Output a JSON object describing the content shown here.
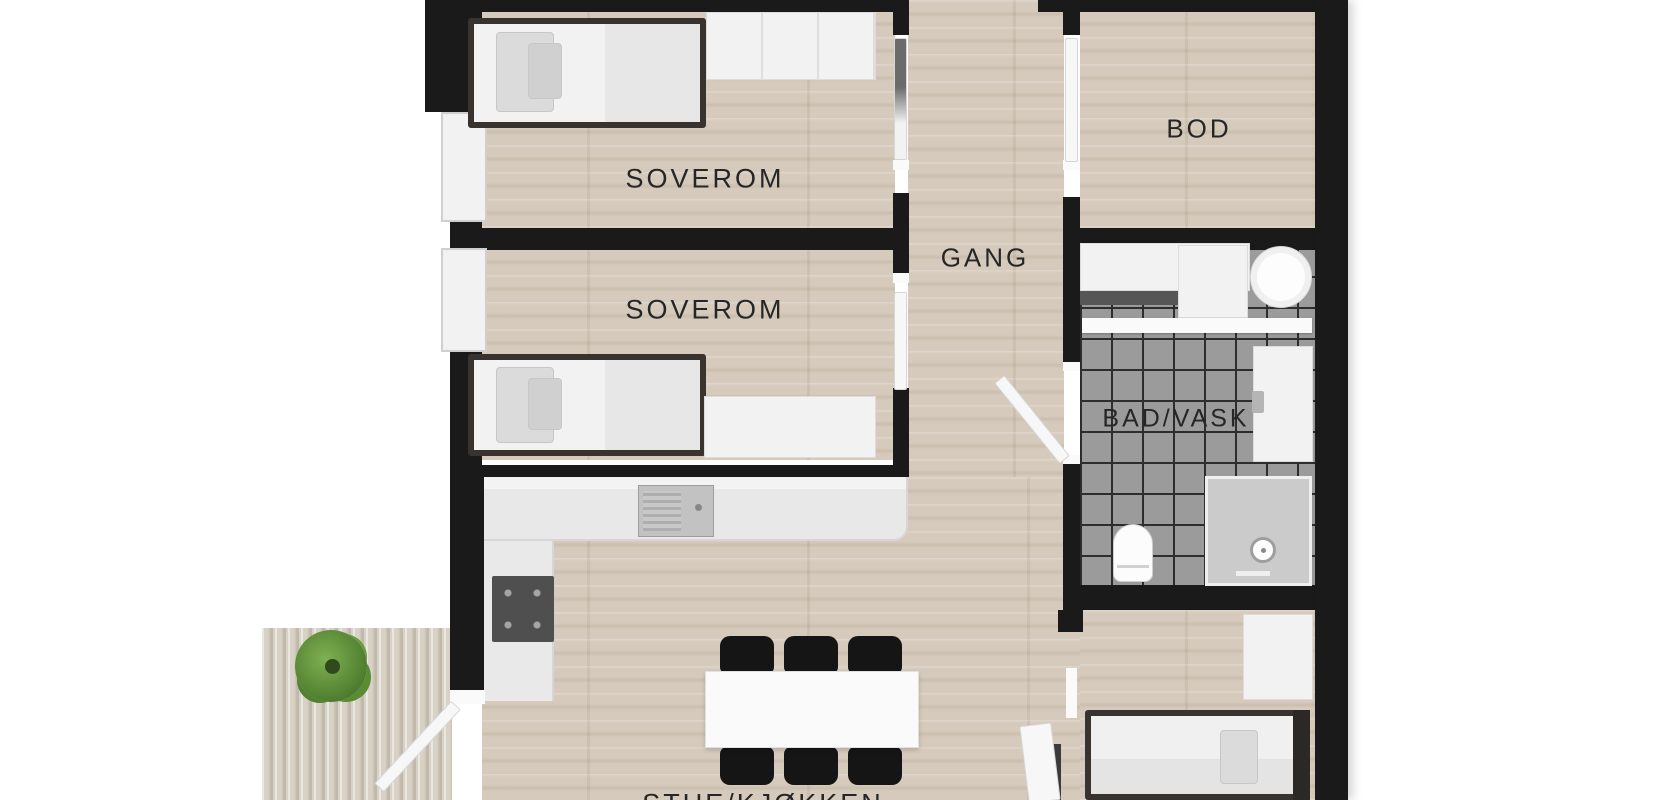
{
  "floorplan": {
    "rooms": [
      {
        "id": "soverom-1",
        "label": "SOVEROM"
      },
      {
        "id": "soverom-2",
        "label": "SOVEROM"
      },
      {
        "id": "gang",
        "label": "GANG"
      },
      {
        "id": "bod",
        "label": "BOD"
      },
      {
        "id": "bad-vask",
        "label": "BAD/VASK"
      },
      {
        "id": "stue-kjokken",
        "label": "STUE/KJØKKEN"
      }
    ],
    "furniture": [
      "bed",
      "wardrobe",
      "desk",
      "kitchen-counter",
      "sink",
      "cooktop",
      "dining-table",
      "dining-chairs",
      "washing-machine",
      "bathroom-counter",
      "vanity",
      "toilet",
      "shower",
      "dresser",
      "plant",
      "deck"
    ],
    "colors": {
      "wall": "#1a1a1a",
      "floor-wood": "#d5cabb",
      "floor-tile": "#9b9b9b",
      "tile-grid": "#2d2d2d",
      "deck-wood": "#d8d2c6",
      "furniture-white": "#f2f2f2",
      "furniture-dark": "#151515",
      "bed-frame": "#38332e",
      "plant-green": "#4e7c2e",
      "label-text": "#262626",
      "background": "#ffffff"
    }
  }
}
